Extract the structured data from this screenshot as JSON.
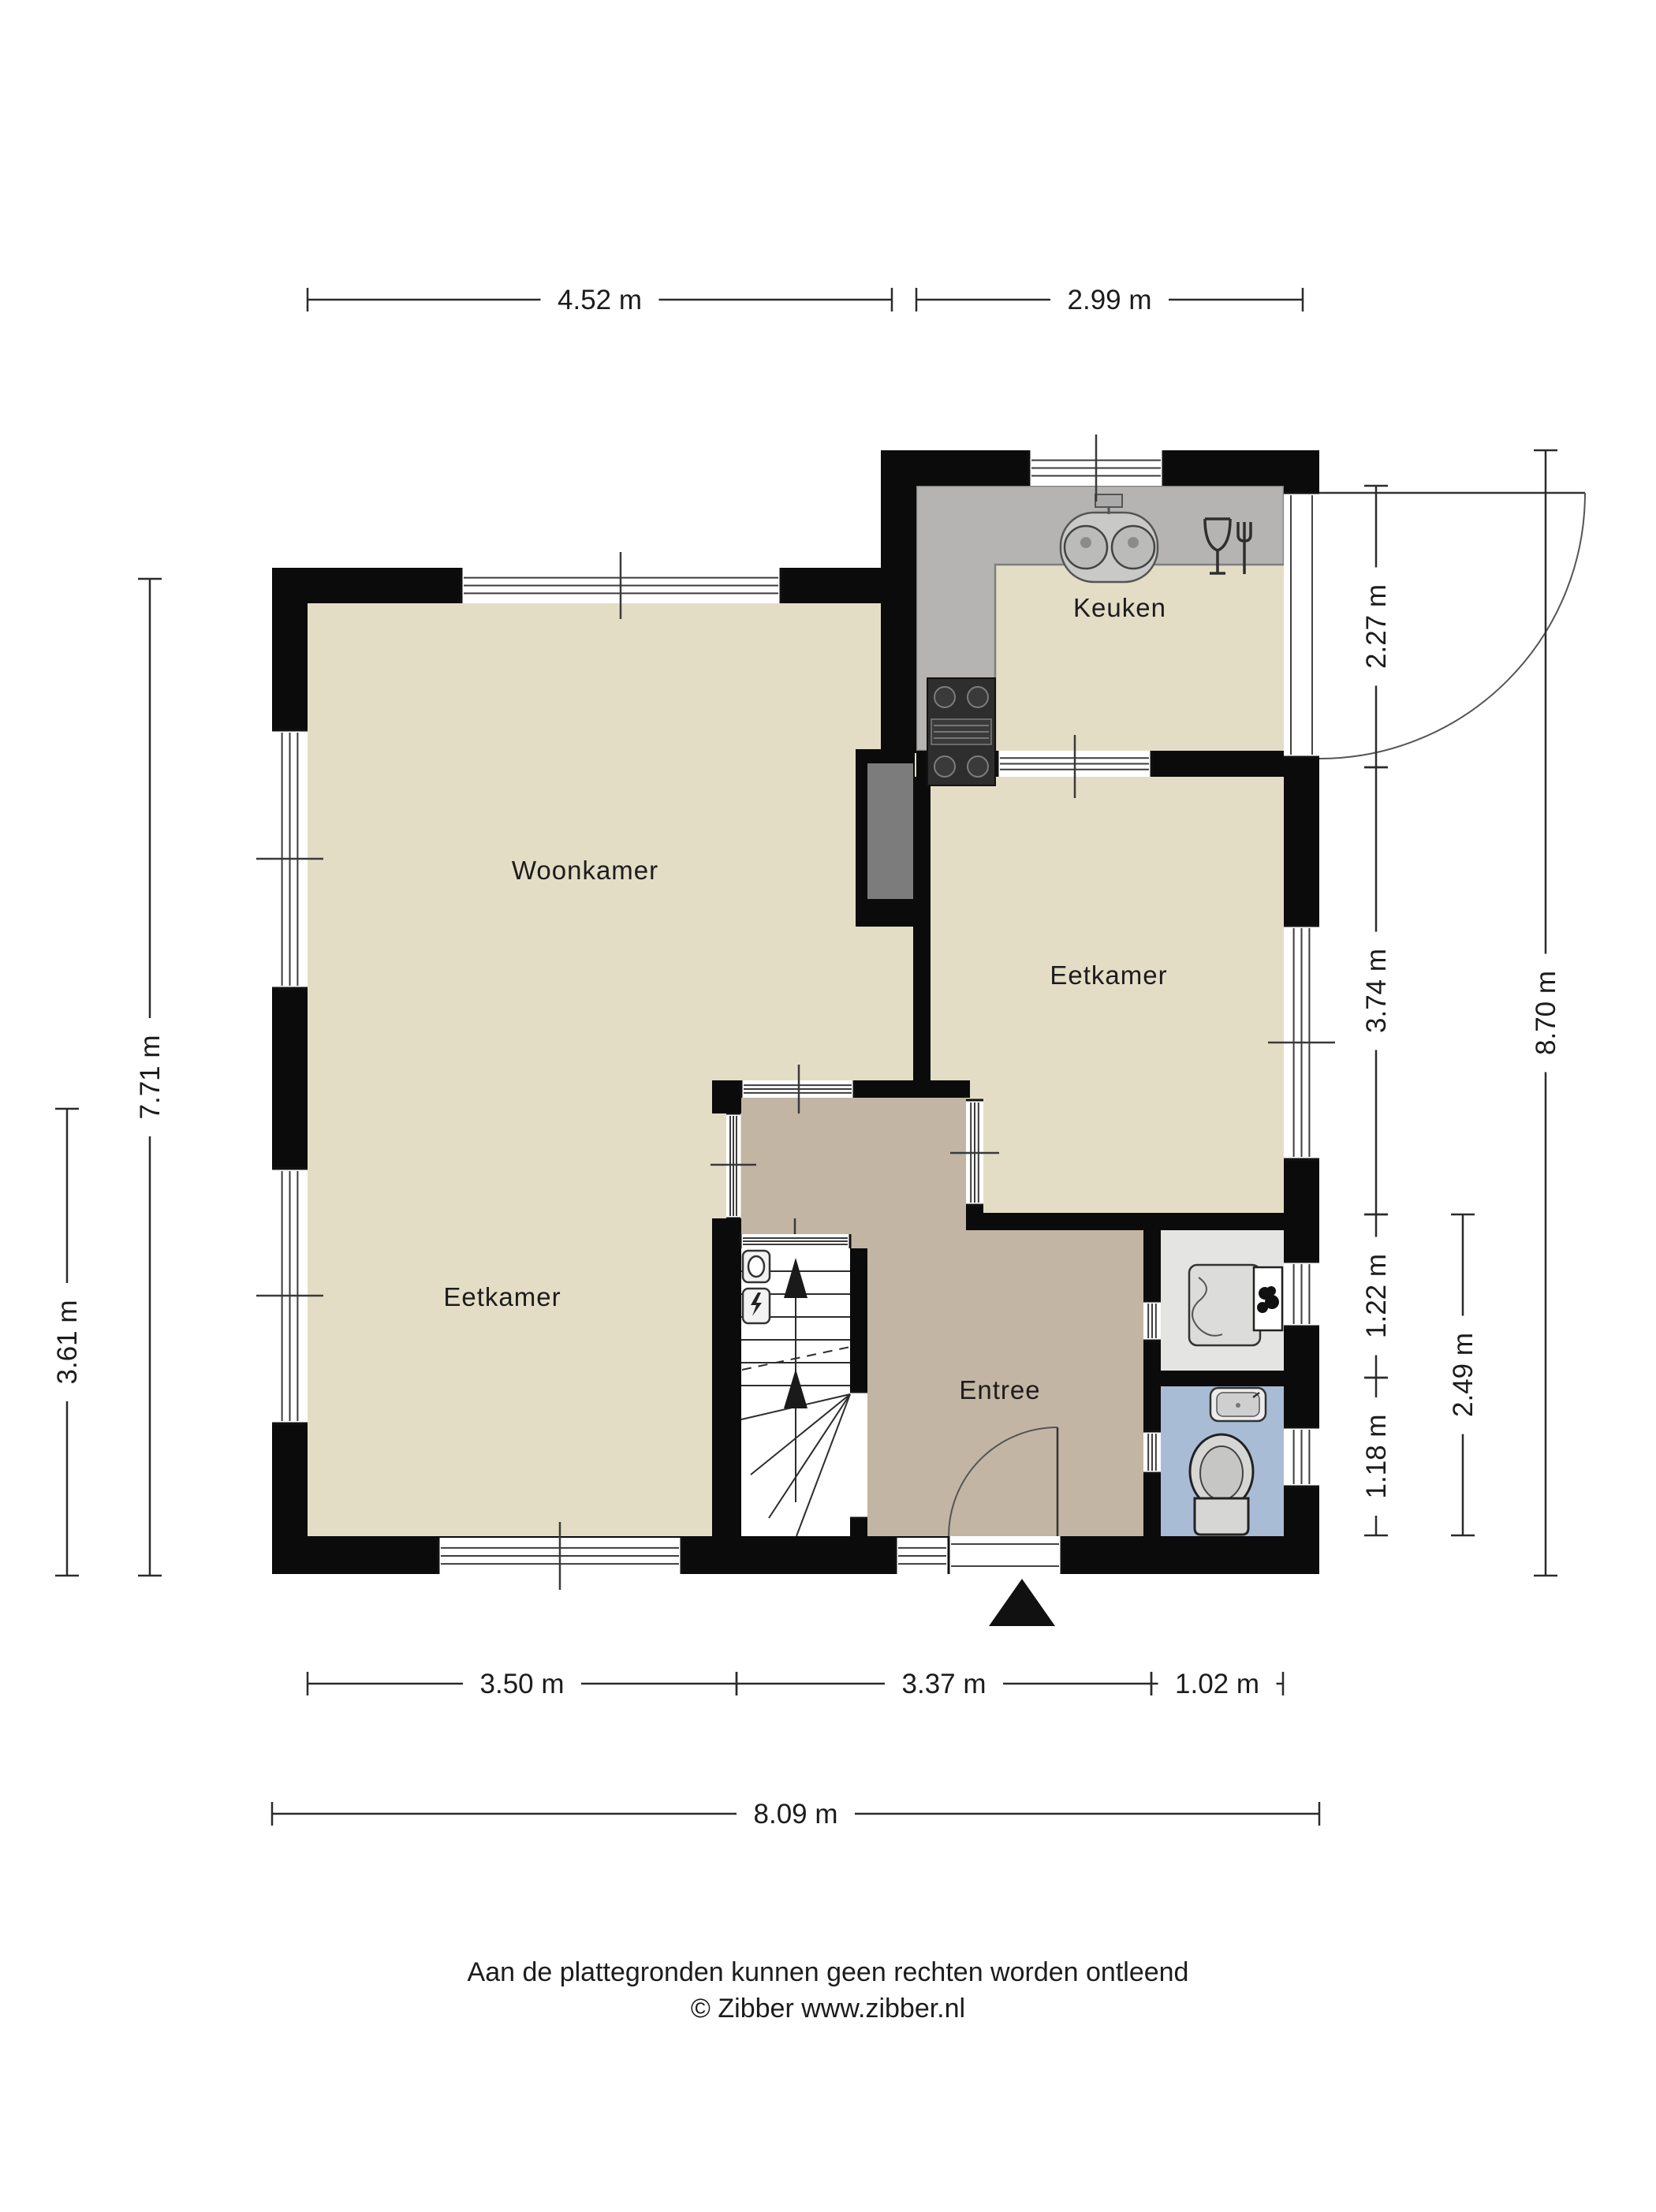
{
  "plan_title": "Begane grond plattegrond",
  "rooms": {
    "woonkamer": "Woonkamer",
    "eetkamer_left": "Eetkamer",
    "eetkamer_right": "Eetkamer",
    "keuken": "Keuken",
    "entree": "Entree"
  },
  "dimensions": {
    "top": [
      {
        "label": "4.52 m"
      },
      {
        "label": "2.99 m"
      }
    ],
    "bottom_inner": [
      {
        "label": "3.50 m"
      },
      {
        "label": "3.37 m"
      },
      {
        "label": "1.02 m"
      }
    ],
    "bottom_total": {
      "label": "8.09 m"
    },
    "left": [
      {
        "label": "7.71 m"
      },
      {
        "label": "3.61 m"
      }
    ],
    "right_inner": [
      {
        "label": "2.27 m"
      },
      {
        "label": "3.74 m"
      },
      {
        "label": "1.22 m"
      },
      {
        "label": "1.18 m"
      }
    ],
    "right_mid": {
      "label": "2.49 m"
    },
    "right_total": {
      "label": "8.70 m"
    }
  },
  "footer": {
    "line1": "Aan de plattegronden kunnen geen rechten worden ontleend",
    "line2": "© Zibber www.zibber.nl"
  },
  "colors": {
    "wall": "#0b0b0b",
    "floor_beige": "#e4ddc6",
    "floor_entree": "#c3b5a4",
    "floor_washroom": "#e4e4e3",
    "floor_toilet": "#a9bcd6",
    "counter_gray": "#b5b4b2",
    "niche_gray": "#7c7c7c",
    "dim_line": "#2b2b2b"
  }
}
